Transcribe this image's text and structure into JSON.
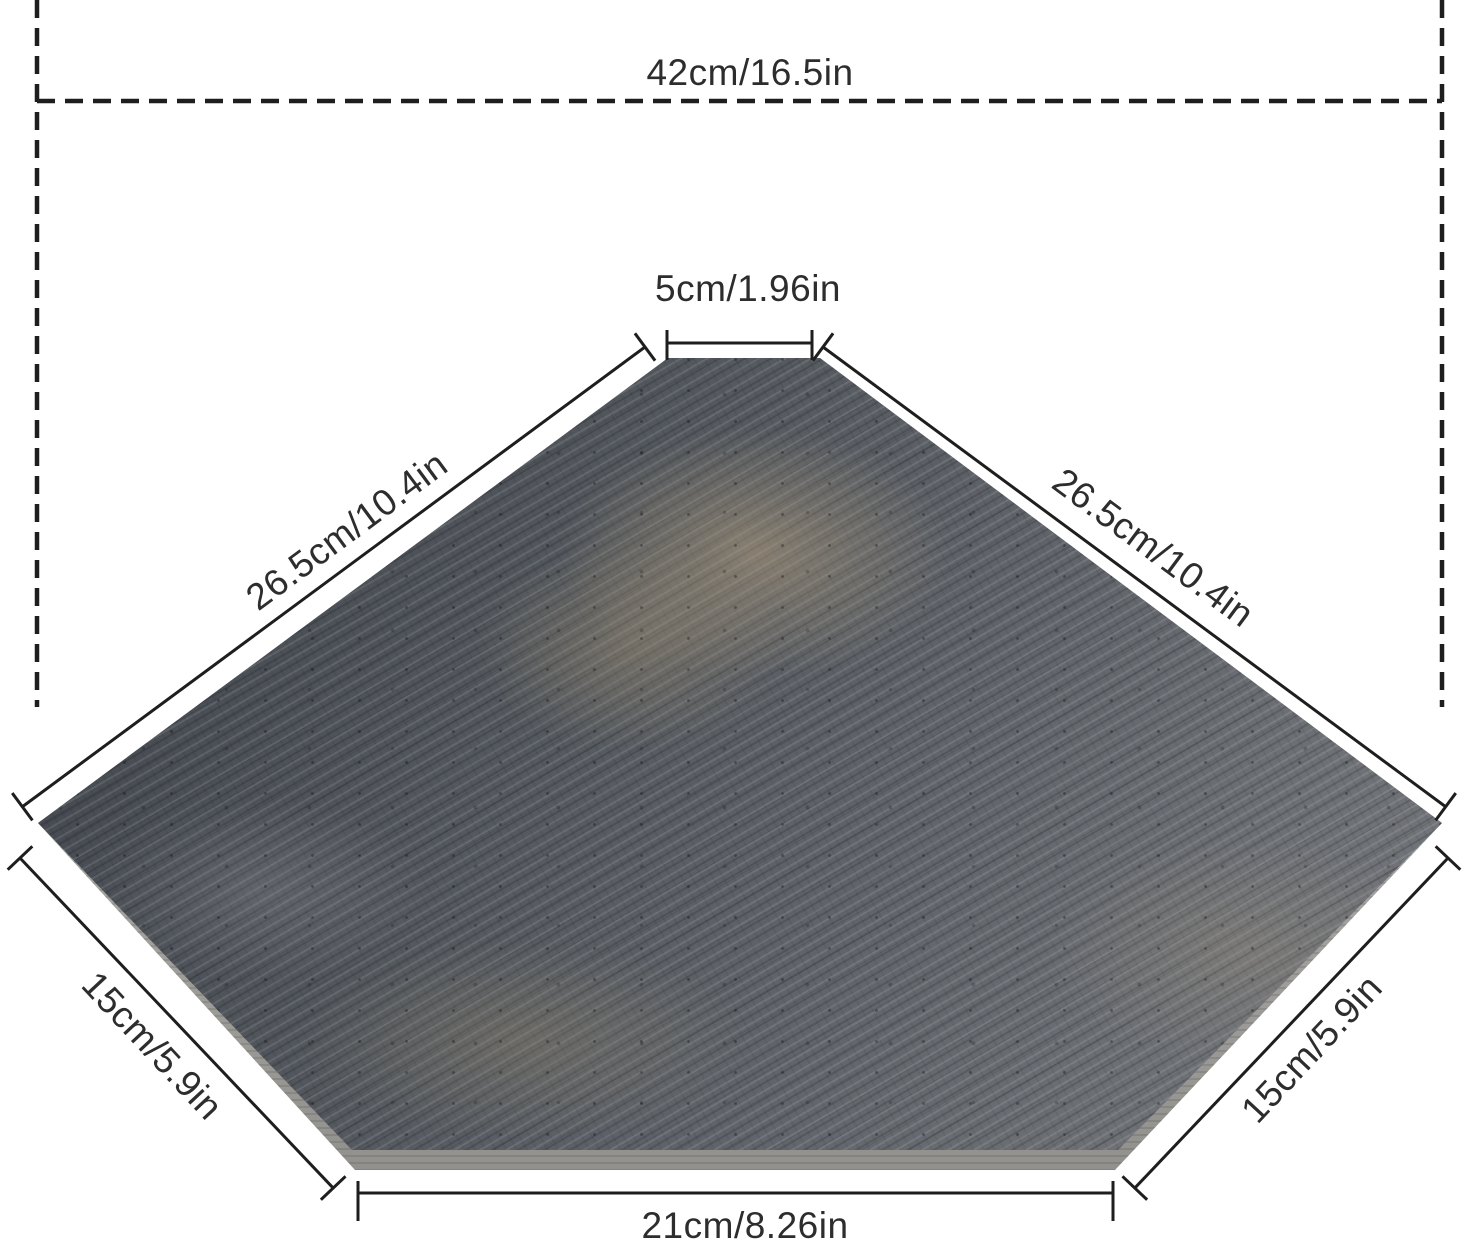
{
  "diagram": {
    "subject": "corner-shelf wooden board dimension diagram",
    "labels": {
      "top_width": "42cm/16.5in",
      "top_edge": "5cm/1.96in",
      "left_diagonal": "26.5cm/10.4in",
      "right_diagonal": "26.5cm/10.4in",
      "left_side": "15cm/5.9in",
      "right_side": "15cm/5.9in",
      "bottom_edge": "21cm/8.26in"
    },
    "colors": {
      "dimension_line": "#1e1e1e",
      "label_text": "#2d2d2d",
      "background": "#ffffff",
      "wood_base": "#565b61",
      "wood_highlight": "#b8a280",
      "board_side": "#bbbab6"
    }
  }
}
